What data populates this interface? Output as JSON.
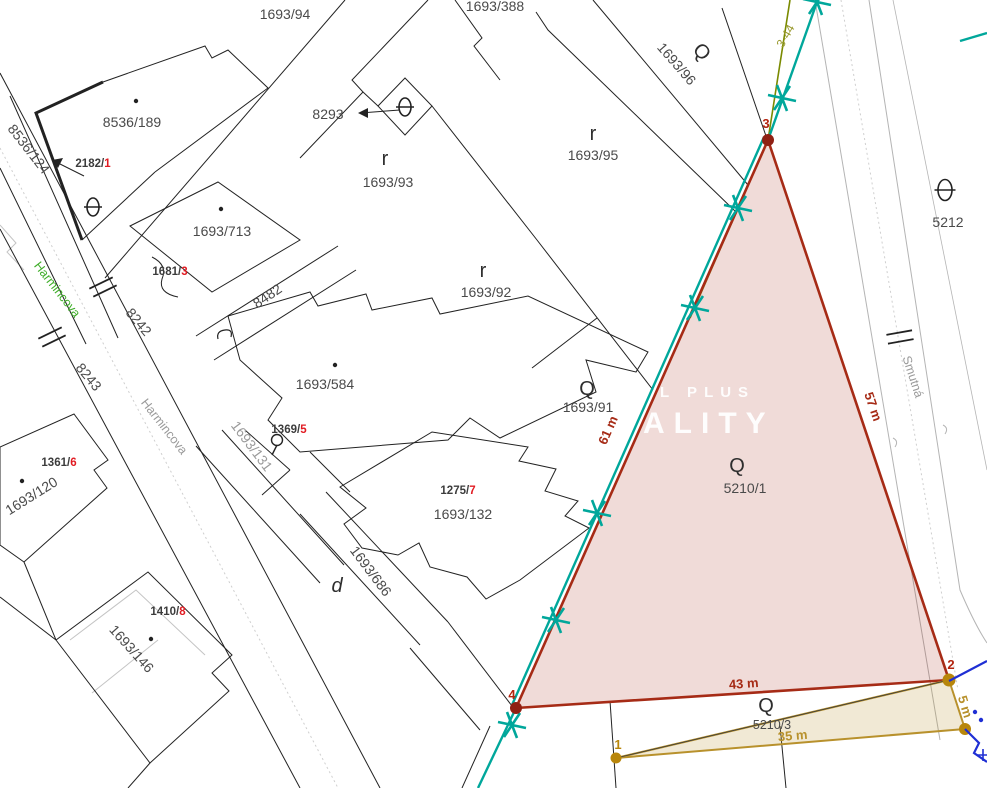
{
  "title": "Cadastral map with highlighted parcel",
  "streets": {
    "harmincova_upper": "Harmincova",
    "harmincova_lower": "Harmincova",
    "smutna": "Smutná"
  },
  "watermark": {
    "line1": "L PLUS",
    "line2": "ALITY"
  },
  "parcels": {
    "p8536_189": "8536/189",
    "p8536_124": "8536/124",
    "p1693_94": "1693/94",
    "p1693_388": "1693/388",
    "p1693_96": "1693/96",
    "p1693_95": "1693/95",
    "p1693_93": "1693/93",
    "p8293": "8293",
    "p1693_713": "1693/713",
    "p8482": "8482",
    "p8242": "8242",
    "p8243": "8243",
    "p1693_92": "1693/92",
    "p1693_91": "1693/91",
    "p1693_584": "1693/584",
    "p1693_131": "1693/131",
    "p1693_120": "1693/120",
    "p1693_132": "1693/132",
    "p1693_686": "1693/686",
    "p1693_146": "1693/146",
    "p5212": "5212",
    "p5210_1": "5210/1",
    "p5210_3": "5210/3"
  },
  "buildings": {
    "b2182": {
      "num": "2182/",
      "ext": "1"
    },
    "b1681": {
      "num": "1681/",
      "ext": "3"
    },
    "b1369": {
      "num": "1369/",
      "ext": "5"
    },
    "b1361": {
      "num": "1361/",
      "ext": "6"
    },
    "b1275": {
      "num": "1275/",
      "ext": "7"
    },
    "b1410": {
      "num": "1410/",
      "ext": "8"
    }
  },
  "measurements": {
    "side_3_4": "61 m",
    "side_3_2": "57 m",
    "side_4_2": "43 m",
    "side_2_2b": "5 m",
    "side_1_2b": "35 m"
  },
  "line_label": "3-44",
  "points": {
    "p1": "1",
    "p2": "2",
    "p3": "3",
    "p4": "4"
  },
  "symbols": {
    "shrub": "r",
    "garden": "Q",
    "script_d": "d"
  },
  "colors": {
    "highlight_border": "#a62b16",
    "highlight_fill": "#f3ded8",
    "survey_teal": "#00a79b",
    "parcel2_border": "#b8912c",
    "parcel2_fill": "#efe6cf",
    "street_green": "#3fae29",
    "road_gray": "#b4b4b4",
    "building_ext_red": "#e11b22",
    "point_red": "#b3240f",
    "water_blue": "#1f2fd4",
    "boundary_olive": "#7a8a00"
  }
}
